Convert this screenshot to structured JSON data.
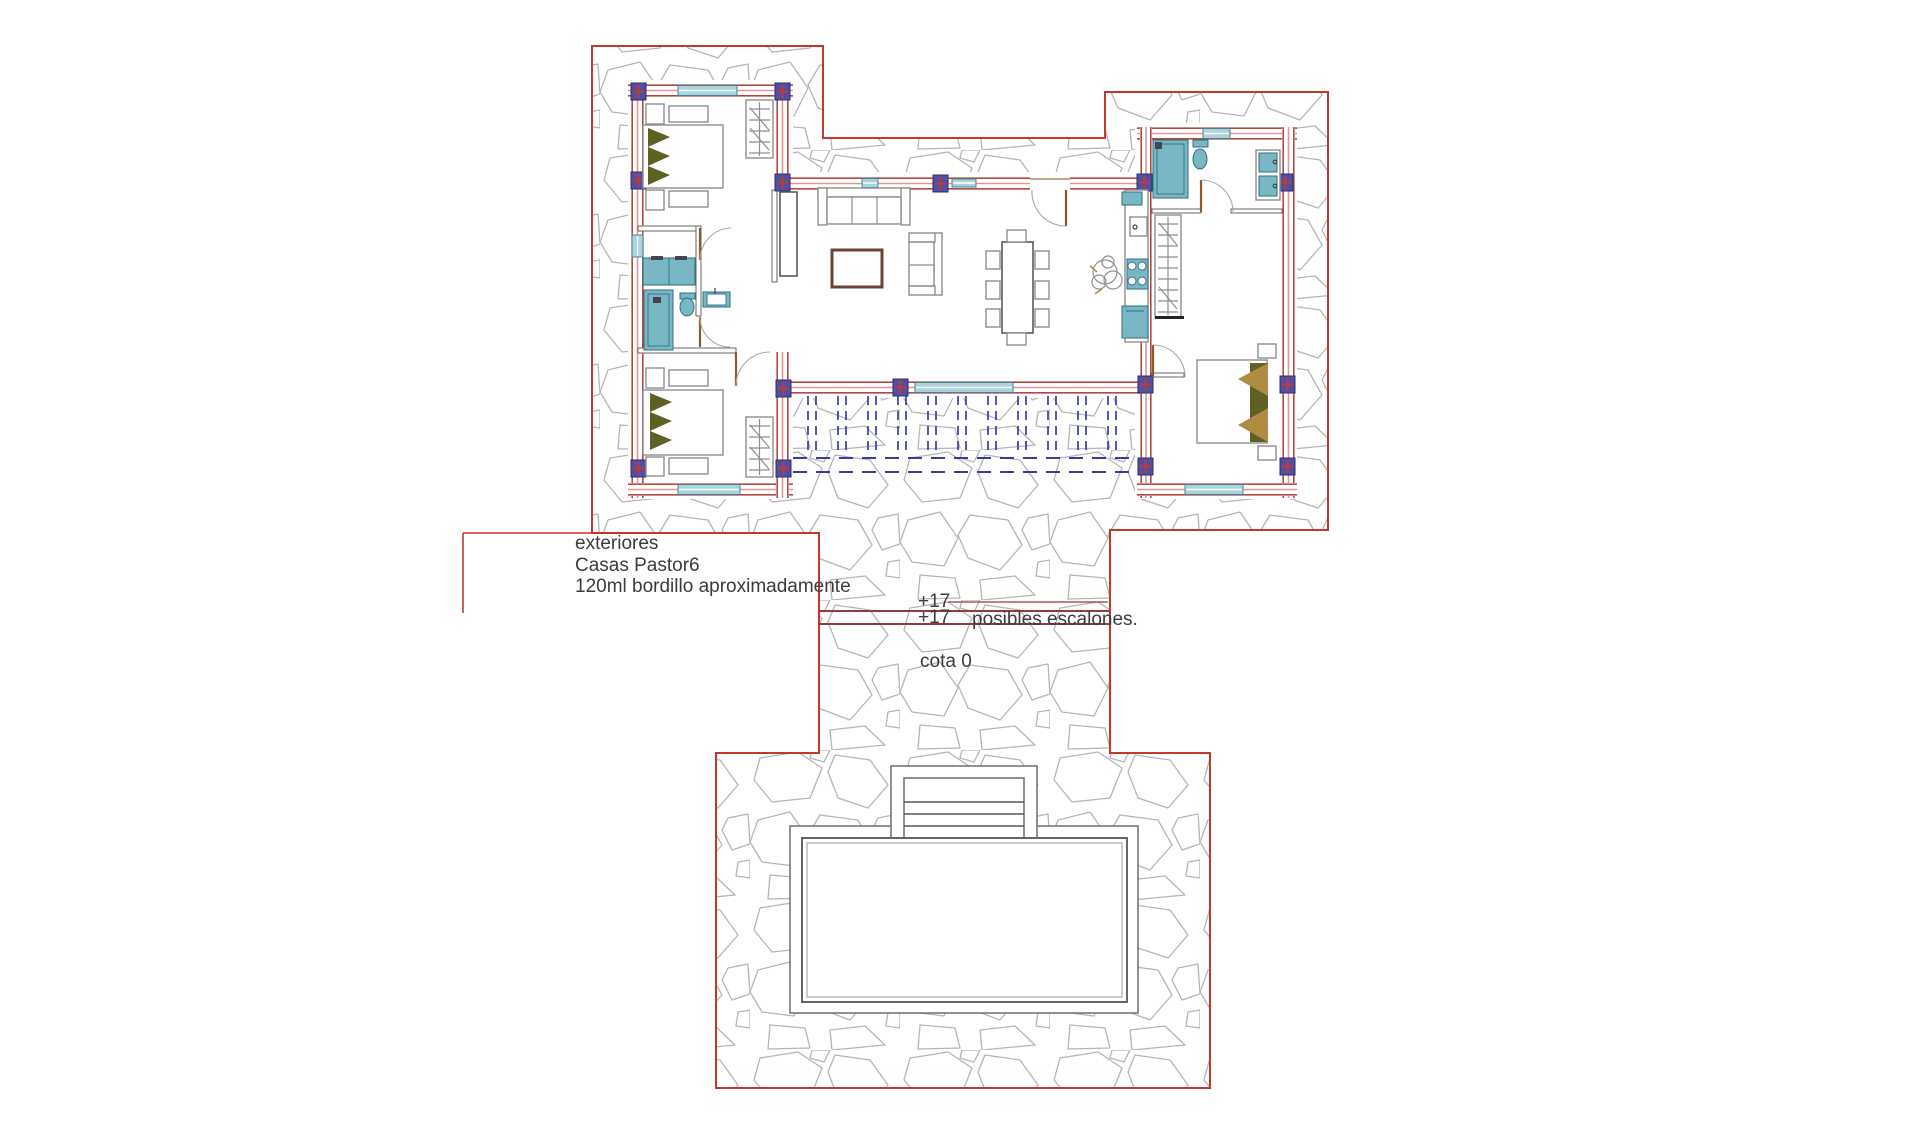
{
  "labels": {
    "exteriores": "exteriores",
    "project": "Casas Pastor6",
    "curb": "120ml bordillo aproximadamente",
    "level_upper": "+17",
    "level_lower": "+17",
    "steps": "posibles escalones.",
    "datum": "cota 0"
  },
  "colors": {
    "boundary-red": "#c0392b",
    "wall-red": "#b24a42",
    "wall-pink": "#dc9a93",
    "column-blue": "#4f4fa6",
    "column-border": "#2c2c6e",
    "column-cross": "#c23b2e",
    "stone-gray": "#b5b5b5",
    "pergola-blue": "#3a3aa8",
    "fixture-teal": "#79b7c5",
    "fixture-teal-dark": "#2e6f80",
    "window-teal": "#a9d3de",
    "window-teal-border": "#3f7f93",
    "bed-olive": "#5f6123",
    "bed-tan": "#b08b42",
    "table-brown": "#6b4336",
    "door-brown": "#8a5a2b",
    "furniture-gray": "#8f8f8f",
    "step-red": "#8f3f39",
    "text-dark": "#3c3c3c",
    "pool-gray": "#777777"
  }
}
